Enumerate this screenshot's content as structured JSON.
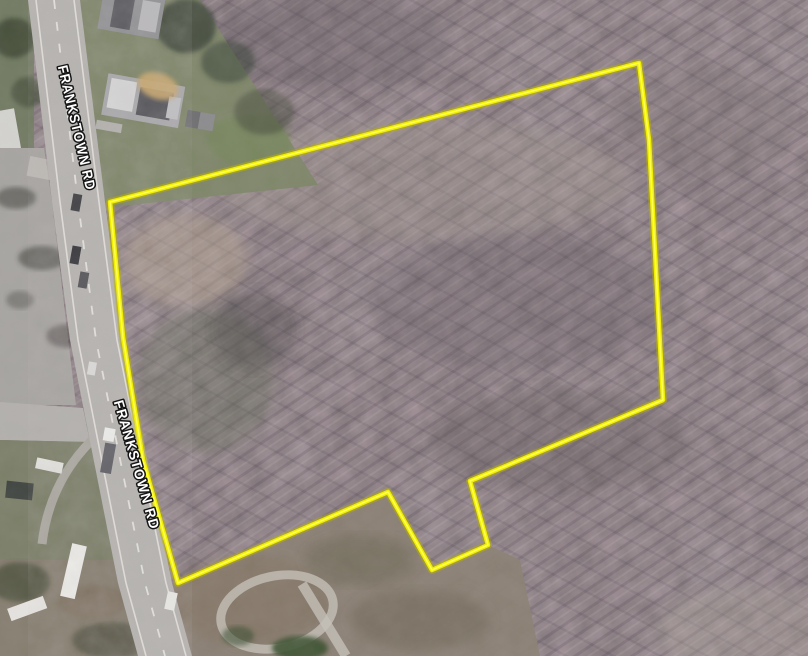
{
  "map": {
    "title": "Aerial parcel map with highlighted lot boundary",
    "road_labels": [
      {
        "text": "FRANKSTOWN RD"
      },
      {
        "text": "FRANKSTOWN RD"
      }
    ],
    "parcel": {
      "boundary_color": "#f0ee00",
      "boundary_points": "110,202 639,63 649,140 663,400 470,481 488,545 432,570 388,492 178,583 143,460 123,337"
    },
    "palette": {
      "forest": "#877d81",
      "road": "#b5b3af",
      "parking_lot": "#a6a4a0",
      "lawn": "#7e8669",
      "brush": "#8a7f73",
      "dirt_patch": "#c9a86f",
      "label_text": "#ffffff",
      "label_outline": "#151515"
    }
  }
}
